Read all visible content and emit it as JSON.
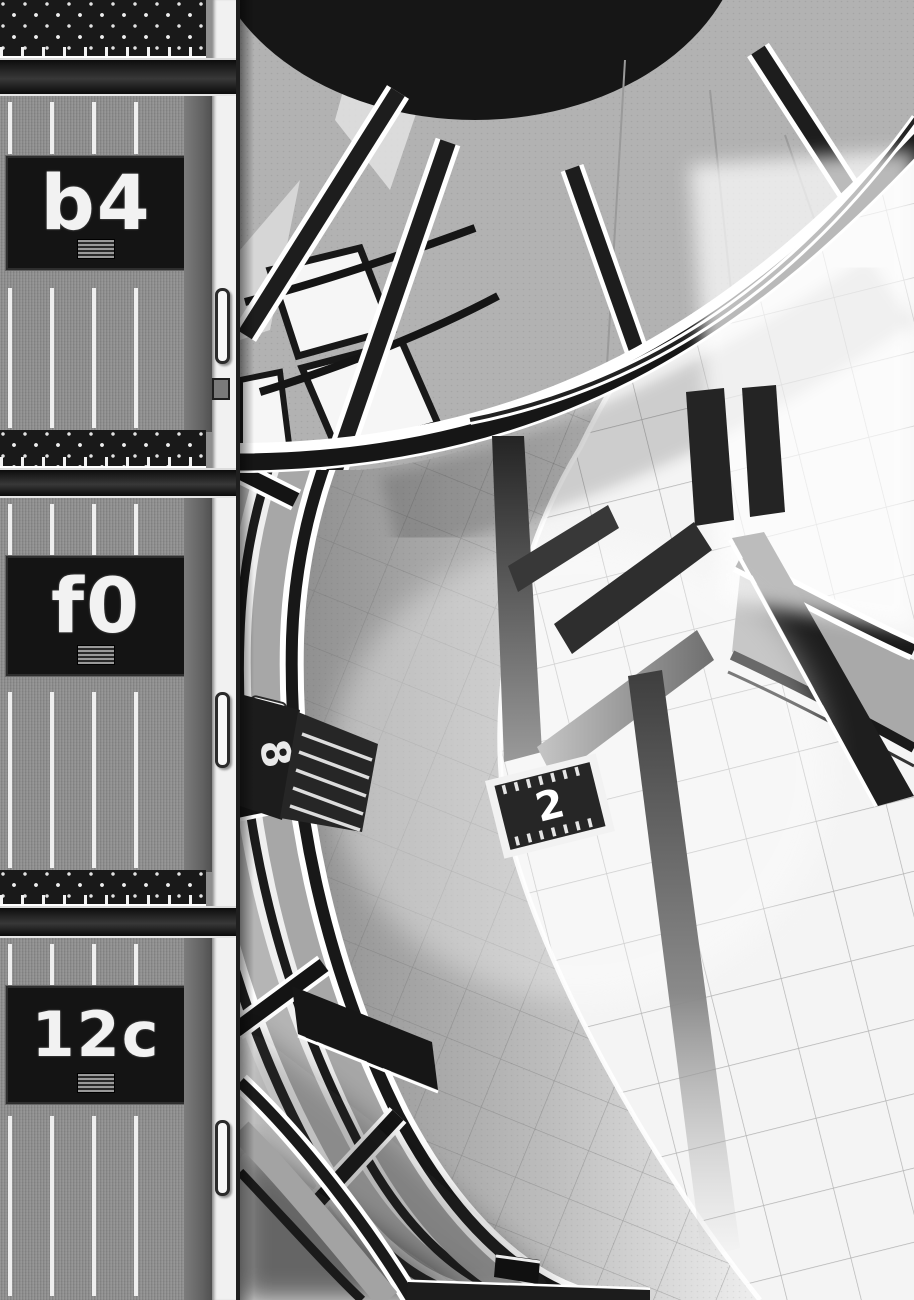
{
  "panel": {
    "medium": "manga page (black and white screentone art)",
    "view": "bird's-eye view into a circular multi-storey atrium"
  },
  "doors": {
    "units": [
      {
        "label": "b4"
      },
      {
        "label": "f0"
      },
      {
        "label": "12c"
      }
    ]
  },
  "atrium": {
    "floor_sign": {
      "label": "2"
    },
    "fascia_sign": {
      "label": "8"
    },
    "sfx_strokes": "large dark katakana-style impact strokes across the tiled floor"
  },
  "colors": {
    "ink": "#161616",
    "tone_gray": "#b2b2b2",
    "paper": "#f4f4f4",
    "door_gray": "#8f8f8f",
    "plate_black": "#141414",
    "label_white": "#f2f2f2"
  }
}
